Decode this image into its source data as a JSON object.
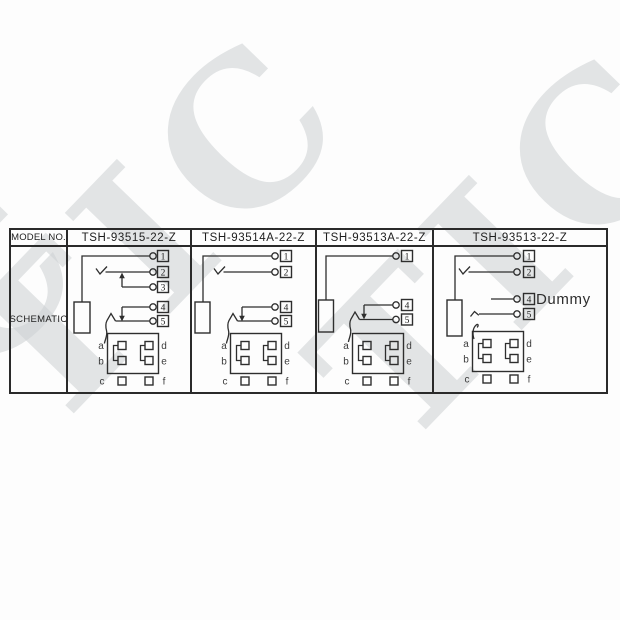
{
  "page": {
    "watermark_text": "TIC"
  },
  "table": {
    "header_label": "MODEL NO.",
    "row_label": "SCHEMATIC"
  },
  "columns": [
    {
      "model": "TSH-93515-22-Z",
      "terminals": {
        "t1": "1",
        "t2": "2",
        "t3": "3",
        "t4": "4",
        "t5": "5"
      },
      "pads": {
        "a": "a",
        "b": "b",
        "c": "c",
        "d": "d",
        "e": "e",
        "f": "f"
      }
    },
    {
      "model": "TSH-93514A-22-Z",
      "terminals": {
        "t1": "1",
        "t2": "2",
        "t4": "4",
        "t5": "5"
      },
      "pads": {
        "a": "a",
        "b": "b",
        "c": "c",
        "d": "d",
        "e": "e",
        "f": "f"
      }
    },
    {
      "model": "TSH-93513A-22-Z",
      "terminals": {
        "t1": "1",
        "t4": "4",
        "t5": "5"
      },
      "pads": {
        "a": "a",
        "b": "b",
        "c": "c",
        "d": "d",
        "e": "e",
        "f": "f"
      }
    },
    {
      "model": "TSH-93513-22-Z",
      "terminals": {
        "t1": "1",
        "t2": "2",
        "t4": "4",
        "t5": "5"
      },
      "dummy_label": "Dummy",
      "pads": {
        "a": "a",
        "b": "b",
        "c": "c",
        "d": "d",
        "e": "e",
        "f": "f"
      }
    }
  ],
  "colors": {
    "line": "#2e2e2e",
    "watermark": "#cdd1d3",
    "background": "#fdfdfd"
  }
}
